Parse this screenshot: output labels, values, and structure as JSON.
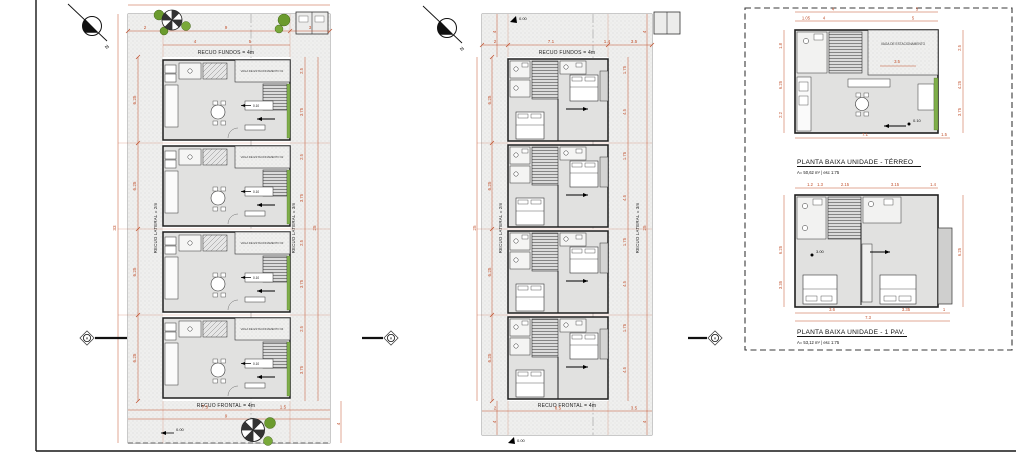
{
  "compass": {
    "label": "N"
  },
  "section": {
    "label": "A"
  },
  "levels": {
    "zero": "0.00",
    "ten": "0.10"
  },
  "site_terreo": {
    "fundos": "RECUO FUNDOS = 4m",
    "frontal": "RECUO FRONTAL = 4m",
    "lat_esq": "RECUO LATERAL = 2m",
    "lat_dir": "RECUO LATERAL = 3m",
    "top": {
      "a": "2",
      "b": "9",
      "c": "3",
      "d": "4",
      "e": "5"
    },
    "left": {
      "total": "33",
      "unit": "6.25"
    },
    "right": {
      "a": "2.5",
      "b": "3.75",
      "total": "25"
    },
    "bottom": {
      "a": "7.5",
      "b": "1.5",
      "c": "9",
      "d": "4"
    },
    "parking": [
      "VAGA DE ESTACIONAMENTO 01",
      "VAGA DE ESTACIONAMENTO 02",
      "VAGA DE ESTACIONAMENTO 03",
      "VAGA DE ESTACIONAMENTO 04"
    ]
  },
  "site_pav": {
    "fundos": "RECUO FUNDOS = 4m",
    "frontal": "RECUO FRONTAL = 4m",
    "lat_esq": "RECUO LATERAL = 2m",
    "lat_dir": "RECUO LATERAL = 3m",
    "top": {
      "a": "2",
      "b": "7.1",
      "c": "1.4",
      "d": "3.5",
      "side": "4"
    },
    "left": {
      "total": "25",
      "unit": "6.25"
    },
    "right": {
      "a": "1.75",
      "b": "4.5",
      "total": "25"
    },
    "bottom": {
      "a": "2",
      "b": "8.5",
      "c": "3.5",
      "side": "4"
    }
  },
  "details": {
    "terreo": {
      "title": "PLANTA BAIXA UNIDADE - TÉRREO",
      "area": "A= 50,62 m²  |  esc 1:75",
      "parking": "VAGA DE ESTACIONAMENTO",
      "mid": "3.5",
      "top": {
        "a": "4",
        "b": "5",
        "c": "1.05"
      },
      "left": {
        "a": "1.8",
        "b": "6.25",
        "c": "2.2"
      },
      "right": {
        "a": "2.5",
        "b": "4.25",
        "c": "3.75"
      },
      "bottom": {
        "a": "7.1",
        "b": "1.5"
      }
    },
    "pav": {
      "title": "PLANTA BAIXA UNIDADE - 1 PAV.",
      "area": "A= 53,12 m²  |  esc 1:75",
      "level": "3.00",
      "top": {
        "a": "1.2",
        "b": "1.3",
        "c": "2.15",
        "d": "3.15",
        "e": "1.4"
      },
      "left": {
        "a": "6.25",
        "b": "3.35"
      },
      "right": {
        "a": "6.25"
      },
      "bottom": {
        "a": "3.6",
        "b": "3.35",
        "c": "1",
        "d": "7.3"
      }
    }
  }
}
